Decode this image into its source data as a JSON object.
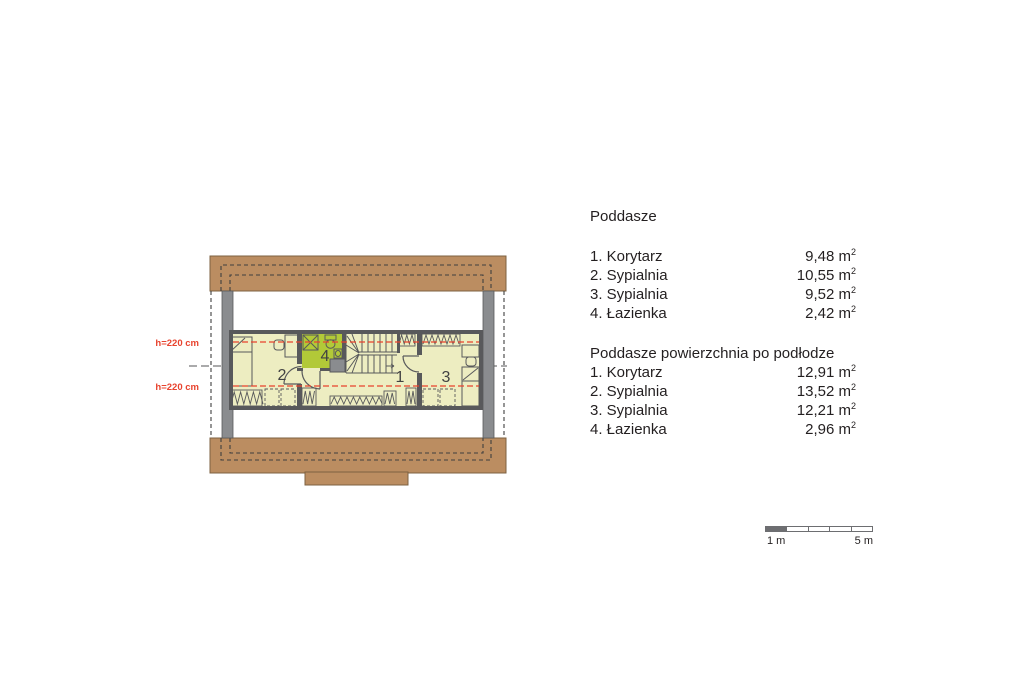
{
  "plan": {
    "height_labels": [
      "h=220 cm",
      "h=220 cm"
    ],
    "room_numbers": {
      "korytarz": "1",
      "sypialnia_left": "2",
      "sypialnia_right": "3",
      "lazienka": "4"
    },
    "colors": {
      "roof_brown": "#bb8d61",
      "roof_outline": "#7d6141",
      "floor_yellow": "#ededc1",
      "bathroom_green": "#b2c938",
      "wall_gray": "#58595b",
      "gable_gray": "#8a8c8f",
      "height_line_red": "#e8432e"
    }
  },
  "legend": {
    "sections": [
      {
        "title": "Poddasze",
        "rows": [
          {
            "label": "1. Korytarz",
            "value": "9,48"
          },
          {
            "label": "2. Sypialnia",
            "value": "10,55"
          },
          {
            "label": "3. Sypialnia",
            "value": "9,52"
          },
          {
            "label": "4. Łazienka",
            "value": "2,42"
          }
        ]
      },
      {
        "title": "Poddasze powierzchnia po podłodze",
        "rows": [
          {
            "label": "1. Korytarz",
            "value": "12,91"
          },
          {
            "label": "2. Sypialnia",
            "value": "13,52"
          },
          {
            "label": "3. Sypialnia",
            "value": "12,21"
          },
          {
            "label": "4. Łazienka",
            "value": "2,96"
          }
        ]
      }
    ],
    "unit": "m",
    "unit_sup": "2"
  },
  "scale_bar": {
    "start_label": "1 m",
    "end_label": "5 m"
  }
}
